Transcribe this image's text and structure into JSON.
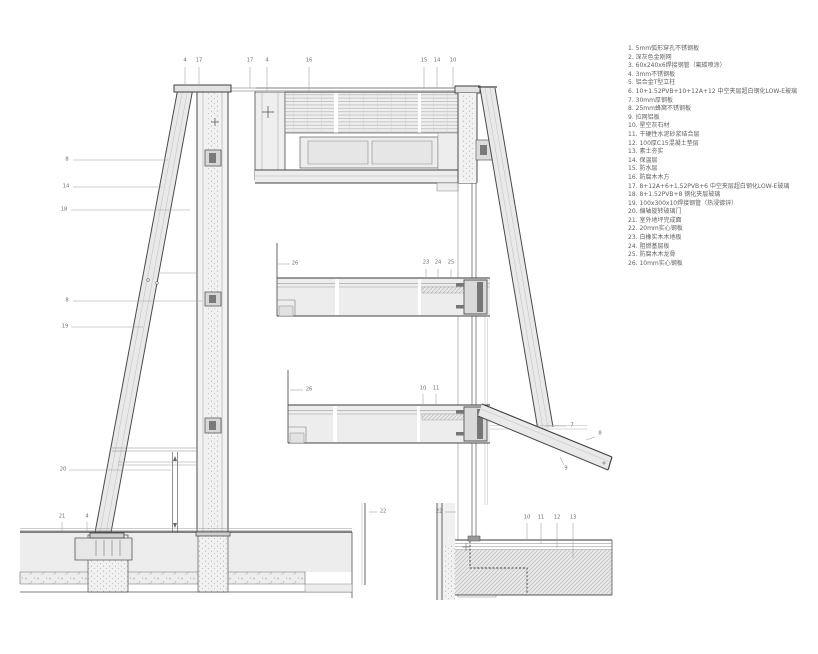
{
  "legend": {
    "items": [
      "1. 5mm弧形穿孔不锈钢板",
      "2. 深灰色金刚网",
      "3. 60x240x6焊接钢管（氟碳喷涂）",
      "4. 3mm不锈钢板",
      "5. 铝合金T型立柱",
      "6. 10+1.52PVB+10+12A+12 中空夹层超白钢化LOW-E玻璃",
      "7. 30mm厚钢板",
      "8. 25mm蜂窝不锈钢板",
      "9. 拉网铝板",
      "10. 星空灰石材",
      "11. 干硬性水泥砂浆结合层",
      "12. 100厚C15混凝土垫层",
      "13. 素土夯实",
      "14. 保温层",
      "15. 防水层",
      "16. 防腐木木方",
      "17. 8+12A+6+1.52PVB+6 中空夹层超白钢化LOW-E玻璃",
      "18. 8+1.52PVB+8 钢化夹层玻璃",
      "19. 100x300x10焊接钢管（热浸镀锌）",
      "20. 偏轴旋转玻璃门",
      "21. 室外地坪完成面",
      "22. 20mm实心钢板",
      "23. 白橡实木木地板",
      "24. 阻燃基层板",
      "25. 防腐木木龙骨",
      "26. 10mm实心钢板"
    ]
  },
  "callouts": [
    {
      "label": "4",
      "x": 185,
      "y": 61,
      "l": [
        185,
        67,
        185,
        86
      ]
    },
    {
      "label": "17",
      "x": 199,
      "y": 61,
      "l": [
        199,
        67,
        199,
        86
      ]
    },
    {
      "label": "17",
      "x": 250,
      "y": 61,
      "l": [
        250,
        67,
        250,
        88
      ]
    },
    {
      "label": "4",
      "x": 267,
      "y": 61,
      "l": [
        267,
        67,
        267,
        91
      ]
    },
    {
      "label": "16",
      "x": 309,
      "y": 61,
      "l": [
        309,
        67,
        309,
        92
      ]
    },
    {
      "label": "15",
      "x": 424,
      "y": 61,
      "l": [
        424,
        67,
        424,
        88
      ]
    },
    {
      "label": "14",
      "x": 437,
      "y": 61,
      "l": [
        437,
        67,
        437,
        88
      ]
    },
    {
      "label": "10",
      "x": 453,
      "y": 61,
      "l": [
        453,
        67,
        453,
        88
      ]
    },
    {
      "label": "8",
      "x": 67,
      "y": 160,
      "l": [
        73,
        160,
        168,
        160
      ]
    },
    {
      "label": "14",
      "x": 66,
      "y": 187,
      "l": [
        73,
        187,
        162,
        187
      ]
    },
    {
      "label": "18",
      "x": 64,
      "y": 210,
      "l": [
        71,
        210,
        190,
        210
      ]
    },
    {
      "label": "8",
      "x": 67,
      "y": 301,
      "l": [
        73,
        301,
        202,
        301
      ]
    },
    {
      "label": "19",
      "x": 65,
      "y": 327,
      "l": [
        71,
        327,
        143,
        327
      ]
    },
    {
      "label": "20",
      "x": 63,
      "y": 470,
      "l": [
        69,
        470,
        171,
        470
      ]
    },
    {
      "label": "21",
      "x": 62,
      "y": 517,
      "l": [
        62,
        522,
        62,
        531
      ]
    },
    {
      "label": "4",
      "x": 87,
      "y": 517,
      "l": [
        87,
        522,
        87,
        531
      ]
    },
    {
      "label": "26",
      "x": 295,
      "y": 264,
      "l": [
        278,
        264,
        290,
        264
      ]
    },
    {
      "label": "23",
      "x": 426,
      "y": 263,
      "l": [
        426,
        269,
        426,
        277
      ]
    },
    {
      "label": "24",
      "x": 438,
      "y": 263,
      "l": [
        438,
        269,
        438,
        277
      ]
    },
    {
      "label": "25",
      "x": 451,
      "y": 263,
      "l": [
        451,
        269,
        451,
        277
      ]
    },
    {
      "label": "26",
      "x": 309,
      "y": 390,
      "l": [
        290,
        390,
        303,
        390
      ]
    },
    {
      "label": "10",
      "x": 423,
      "y": 389,
      "l": [
        423,
        394,
        423,
        404
      ]
    },
    {
      "label": "11",
      "x": 436,
      "y": 389,
      "l": [
        436,
        394,
        436,
        404
      ]
    },
    {
      "label": "7",
      "x": 572,
      "y": 426,
      "l": [
        545,
        426,
        566,
        426
      ]
    },
    {
      "label": "8",
      "x": 600,
      "y": 434,
      "l": [
        586,
        440,
        595,
        437
      ]
    },
    {
      "label": "9",
      "x": 566,
      "y": 469,
      "l": [
        560,
        457,
        564,
        465
      ]
    },
    {
      "label": "22",
      "x": 383,
      "y": 512,
      "l": [
        369,
        512,
        377,
        512
      ]
    },
    {
      "label": "22",
      "x": 439,
      "y": 512,
      "l": [
        445,
        512,
        456,
        512
      ]
    },
    {
      "label": "10",
      "x": 527,
      "y": 518,
      "l": [
        527,
        523,
        527,
        541
      ]
    },
    {
      "label": "11",
      "x": 541,
      "y": 518,
      "l": [
        541,
        523,
        541,
        544
      ]
    },
    {
      "label": "12",
      "x": 557,
      "y": 518,
      "l": [
        557,
        523,
        557,
        548
      ]
    },
    {
      "label": "13",
      "x": 573,
      "y": 518,
      "l": [
        573,
        523,
        573,
        558
      ]
    }
  ],
  "colors": {
    "outline": "#3f3f3f",
    "fill_light": "#ececec",
    "hatch": "#b2b2b2",
    "leader": "#9f9f9f",
    "text": "#5f5f5f"
  }
}
